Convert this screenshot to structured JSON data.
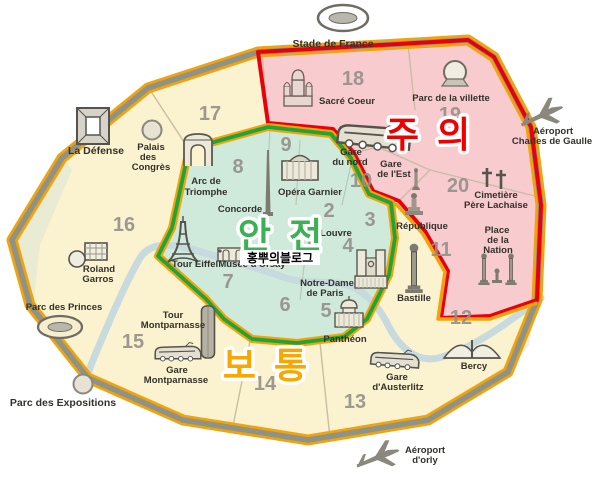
{
  "page": {
    "background": "#ffffff",
    "description": "Paris arrondissement safety map with Korean zone ratings"
  },
  "zones": {
    "caution": {
      "label": "주 의",
      "text_color": "#ee0000",
      "fill": "#f8cbcf",
      "border": "#e8000d"
    },
    "safe": {
      "label": "안 전",
      "text_color": "#3cb054",
      "fill": "#cfe9da",
      "border": "#1fa43c"
    },
    "normal": {
      "label": "보 통",
      "text_color": "#f6a800",
      "fill": "#fbf2cf",
      "border": "#f0a30a"
    }
  },
  "watermark": {
    "text": "홍뿌의블로그",
    "bg": "#ffffff",
    "color": "#000000"
  },
  "districts": {
    "d1": "1",
    "d2": "2",
    "d3": "3",
    "d4": "4",
    "d5": "5",
    "d6": "6",
    "d7": "7",
    "d8": "8",
    "d9": "9",
    "d10": "10",
    "d11": "11",
    "d12": "12",
    "d13": "13",
    "d14": "14",
    "d15": "15",
    "d16": "16",
    "d17": "17",
    "d18": "18",
    "d19": "19",
    "d20": "20"
  },
  "landmarks": {
    "stade_de_france": [
      "Stade de France"
    ],
    "sacre_coeur": [
      "Sacré Coeur"
    ],
    "parc_de_la_villette": [
      "Parc de la villette"
    ],
    "aeroport_cdg": [
      "Aéroport",
      "Charles de Gaulle"
    ],
    "la_defense": [
      "La Défense"
    ],
    "palais_des_congres": [
      "Palais",
      "des",
      "Congrès"
    ],
    "arc_de_triomphe": [
      "Arc de",
      "Triomphe"
    ],
    "concorde": [
      "Concorde"
    ],
    "opera_garnier": [
      "Opéra Garnier"
    ],
    "gare_du_nord": [
      "Gare",
      "du nord"
    ],
    "gare_de_lest": [
      "Gare",
      "de l'Est"
    ],
    "cimetiere_pere_lachaise": [
      "Cimetière",
      "Père Lachaise"
    ],
    "republique": [
      "République"
    ],
    "place_de_la_nation": [
      "Place",
      "de la",
      "Nation"
    ],
    "tour_eiffel": [
      "Tour Eiffel"
    ],
    "musee_dorsay": [
      "Musée d'Orsay"
    ],
    "louvre": [
      "Louvre"
    ],
    "notre_dame": [
      "Notre-Dame",
      "de Paris"
    ],
    "bastille": [
      "Bastille"
    ],
    "pantheon": [
      "Panthéon"
    ],
    "tour_montparnasse": [
      "Tour",
      "Montparnasse"
    ],
    "gare_montparnasse": [
      "Gare",
      "Montparnasse"
    ],
    "roland_garros": [
      "Roland",
      "Garros"
    ],
    "parc_des_princes": [
      "Parc des Princes"
    ],
    "parc_des_expositions": [
      "Parc des Expositions"
    ],
    "gare_austerlitz": [
      "Gare",
      "d'Austerlitz"
    ],
    "bercy": [
      "Bercy"
    ],
    "aeroport_orly": [
      "Aéroport",
      "d'orly"
    ]
  },
  "icons": [
    "stadium-icon",
    "basilica-icon",
    "geode-icon",
    "airplane-icon",
    "grande-arche-icon",
    "circle-venue-icon",
    "triumphal-arch-icon",
    "obelisk-icon",
    "opera-house-icon",
    "train-icon",
    "cemetery-crosses-icon",
    "column-monument-icon",
    "statue-icon",
    "eiffel-tower-icon",
    "cathedral-icon",
    "pantheon-dome-icon",
    "skyscraper-icon",
    "tennis-icon",
    "bercy-building-icon",
    "museum-icon"
  ]
}
